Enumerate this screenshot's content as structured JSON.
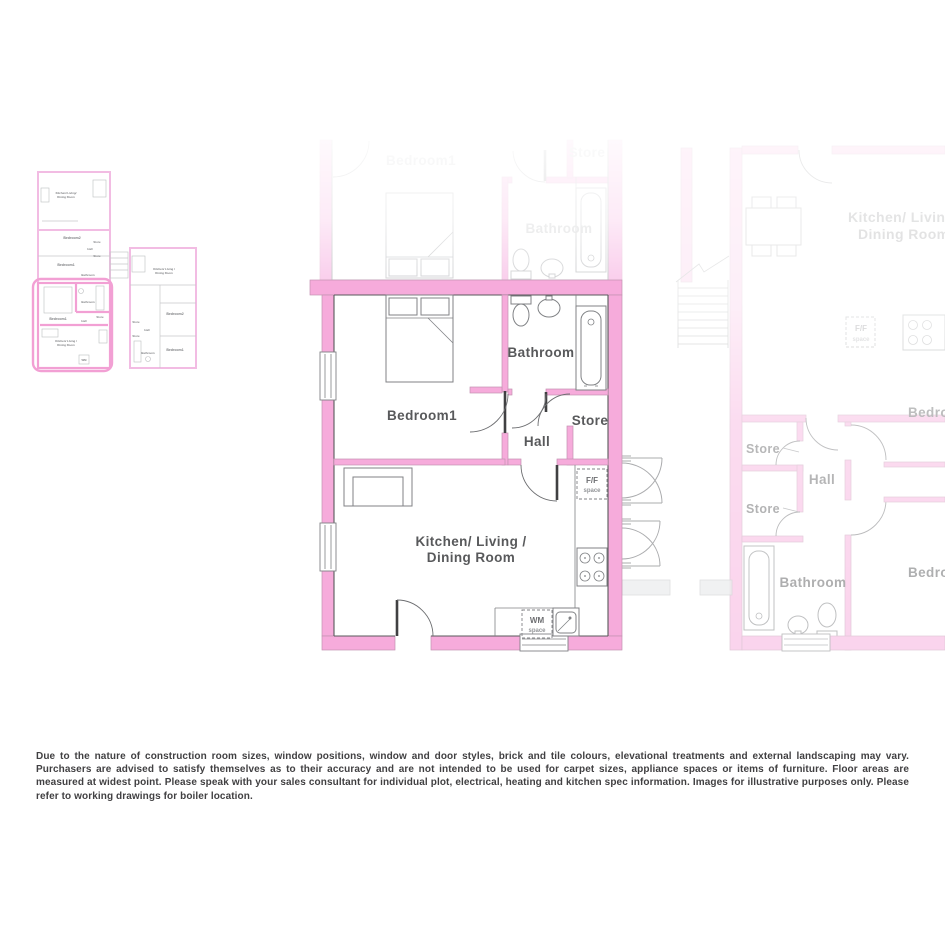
{
  "colors": {
    "wall_pink": "#F6ABDB",
    "wall_faded": "#F9C9EA",
    "highlight_pink": "#F2A0D4",
    "label_dark": "#58595B",
    "label_faded": "#D9DADB",
    "disclaimer_text": "#414042"
  },
  "main_plan": {
    "bedroom": "Bedroom1",
    "bathroom": "Bathroom",
    "hall": "Hall",
    "store": "Store",
    "kitchen_line1": "Kitchen/ Living /",
    "kitchen_line2": "Dining Room",
    "fridge_line1": "F/F",
    "fridge_line2": "space",
    "washer_line1": "WM",
    "washer_line2": "space"
  },
  "upper_plan": {
    "bedroom": "Bedroom1",
    "bathroom": "Bathroom",
    "store": "Store"
  },
  "right_plan": {
    "kitchen_line1": "Kitchen/ Living /",
    "kitchen_line2": "Dining Room",
    "fridge_line1": "F/F",
    "fridge_line2": "space",
    "store_top": "Store",
    "store_bottom": "Store",
    "hall": "Hall",
    "bathroom": "Bathroom",
    "bedroom_top": "Bedroom2",
    "bedroom_bottom": "Bedroom1"
  },
  "site_overview": {
    "building_a": {
      "kitchen_l1": "Kitchen/ Living/",
      "kitchen_l2": "Dining Room",
      "bedroom2": "Bedroom2",
      "hall": "Hall",
      "store_a": "Store",
      "store_b": "Store",
      "bedroom1": "Bedroom1",
      "bathroom": "Bathroom",
      "flat": {
        "bedroom": "Bedroom1",
        "bathroom": "Bathroom",
        "hall": "Hall",
        "store": "Store",
        "kitchen_l1": "Kitchen/ Living /",
        "kitchen_l2": "Dining Room",
        "washer": "WM"
      }
    },
    "building_b": {
      "kitchen_l1": "Kitchen/ Living /",
      "kitchen_l2": "Dining Room",
      "bedroom2": "Bedroom2",
      "store_top": "Store",
      "hall": "Hall",
      "store_bottom": "Store",
      "bathroom": "Bathroom",
      "bedroom1": "Bedroom1"
    }
  },
  "disclaimer": "Due to the nature of construction room sizes, window positions, window and door styles, brick and tile colours, elevational treatments and external landscaping may vary. Purchasers are advised to satisfy themselves as to their accuracy and are not intended to be used for carpet sizes, appliance spaces or items of furniture. Floor areas are measured at widest point. Please speak with your sales consultant for individual plot, electrical, heating and kitchen spec information. Images for illustrative purposes only. Please refer to working drawings for boiler location."
}
